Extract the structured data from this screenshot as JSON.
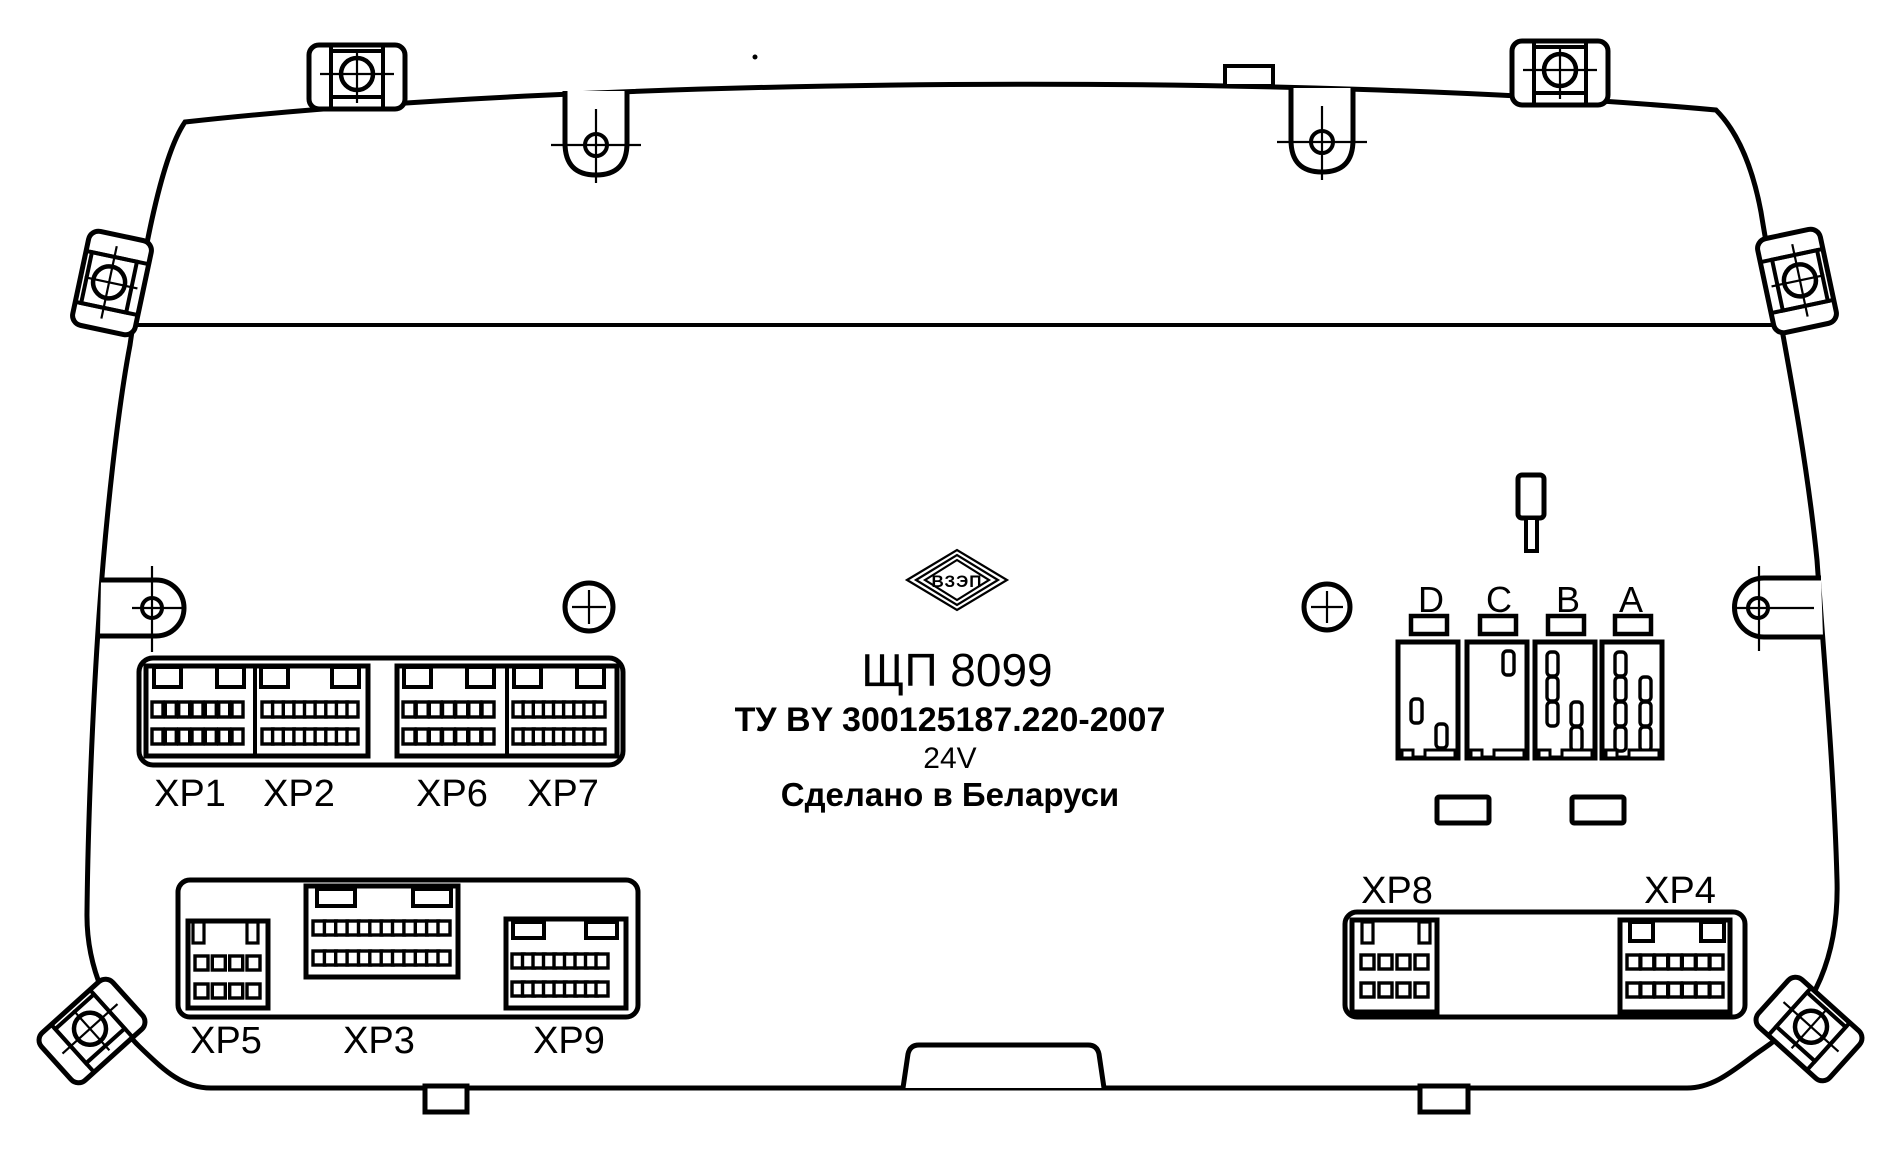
{
  "device": {
    "model": "ЩП 8099",
    "standard": "ТУ BY 300125187.220-2007",
    "voltage": "24V",
    "made_in": "Сделано в Беларуси",
    "logo": "ВЗЭП"
  },
  "connectors": {
    "top_strip": [
      {
        "id": "XP1",
        "rows": 2,
        "pins_per_row": 7
      },
      {
        "id": "XP2",
        "rows": 2,
        "pins_per_row": 9
      },
      {
        "id": "XP6",
        "rows": 2,
        "pins_per_row": 7
      },
      {
        "id": "XP7",
        "rows": 2,
        "pins_per_row": 9
      }
    ],
    "bottom_left": [
      {
        "id": "XP5",
        "rows": 2,
        "pins_per_row": 4
      },
      {
        "id": "XP3",
        "rows": 2,
        "pins_per_row": 12
      },
      {
        "id": "XP9",
        "rows": 2,
        "pins_per_row": 9
      }
    ],
    "bottom_right": [
      {
        "id": "XP8",
        "rows": 2,
        "pins_per_row": 4
      },
      {
        "id": "XP4",
        "rows": 2,
        "pins_per_row": 7
      }
    ],
    "relay_slots": [
      {
        "id": "D"
      },
      {
        "id": "C"
      },
      {
        "id": "B"
      },
      {
        "id": "A"
      }
    ]
  },
  "colors": {
    "line": "#000000",
    "background": "#ffffff"
  }
}
